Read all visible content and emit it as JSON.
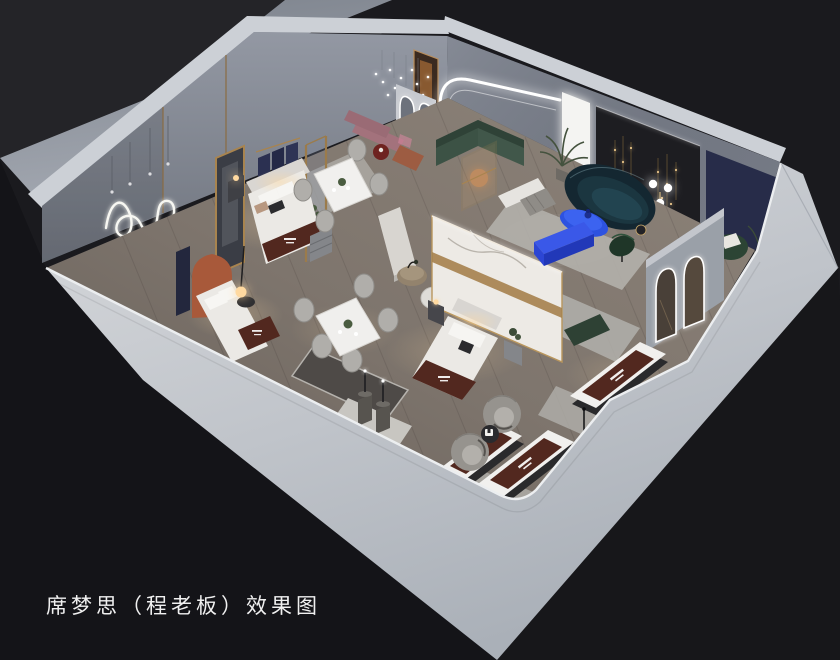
{
  "caption": "席梦思（程老板）效果图",
  "scene_type": "3d-interior-showroom-render",
  "view": "isometric-cutaway",
  "palette": {
    "bg": "#1a1a1e",
    "bg_top": "#242428",
    "bg_bottom": "#141418",
    "ground": "#969ba5",
    "wall_outer": "#c3c6cc",
    "wall_top": "#ccd0d6",
    "wall_face": "#868b96",
    "floor": "#7e756d",
    "floor_light": "#8d8379",
    "rug": "#b2b0ab",
    "marble": "#edeae5",
    "gold": "#a5814d",
    "navy": "#272c49",
    "accent_dark": "#1d1d21",
    "maroon": "#52281f",
    "blue": "#2d52e0",
    "teal_sofa": "#142731",
    "green_sofa": "#3c5245",
    "terracotta": "#a8593a",
    "mauve": "#a3727c",
    "bed_white": "#ebe9e5",
    "led": "#ffffff",
    "lamp_warm": "#ffd9a0",
    "caption_color": "#f0f0f0"
  }
}
